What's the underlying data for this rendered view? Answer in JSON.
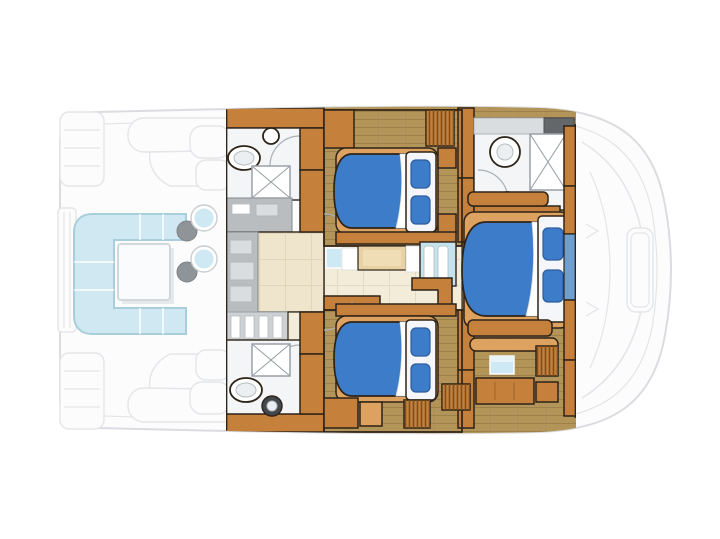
{
  "canvas": {
    "width": 720,
    "height": 539,
    "background": "#ffffff"
  },
  "plan": {
    "type": "floorplan",
    "subject": "catamaran-motor-yacht-lower-deck",
    "view": "overhead",
    "rooms": [
      {
        "id": "stern-platforms",
        "items": [
          "swim-platform-upper",
          "swim-platform-lower",
          "transom-steps"
        ]
      },
      {
        "id": "aft-cockpit",
        "items": [
          "u-shaped-sofa",
          "square-table",
          "bistro-table",
          "bistro-table",
          "chair",
          "chair"
        ]
      },
      {
        "id": "guest-head-forward",
        "items": [
          "toilet",
          "sink",
          "shower"
        ]
      },
      {
        "id": "galley",
        "items": [
          "counter",
          "sink-counter",
          "appliances",
          "steps-down"
        ]
      },
      {
        "id": "guest-head-aft",
        "items": [
          "toilet",
          "sink",
          "shower"
        ]
      },
      {
        "id": "guest-cabin-forward",
        "items": [
          "double-bed",
          "wardrobe",
          "louver-vent"
        ]
      },
      {
        "id": "companionway",
        "items": [
          "bench-seat",
          "cushion",
          "steps",
          "handrail"
        ]
      },
      {
        "id": "guest-cabin-aft",
        "items": [
          "double-bed",
          "wardrobe",
          "louver-vents"
        ]
      },
      {
        "id": "master-head",
        "items": [
          "toilet",
          "sink",
          "shower",
          "vanity-counter"
        ]
      },
      {
        "id": "master-cabin",
        "items": [
          "double-bed",
          "shelf",
          "stool",
          "desk",
          "louver-lockers",
          "chest",
          "hull-window"
        ]
      },
      {
        "id": "foredeck-ghost",
        "items": [
          "bow-hatch",
          "sun-lounge-outline",
          "deck-lines"
        ]
      }
    ],
    "counts": {
      "beds": 3,
      "heads": 3,
      "showers": 3,
      "toilets": 3,
      "sinks": 3
    }
  },
  "colors": {
    "outline": "#2e2317",
    "woodTrim": "#c5803c",
    "woodTrimLight": "#dda25f",
    "woodFloor": "#b3955a",
    "plankLine": "#8a6d39",
    "beigeFloor": "#efe5cd",
    "creamFloor": "#f3ecd9",
    "bathFloor": "#f3f5f7",
    "counterGrey": "#b9bdbf",
    "counterDark": "#63676a",
    "bedBlue": "#3d7cc9",
    "pillowBlue": "#3d7cc9",
    "bedWhite": "#f4f6f9",
    "sofaBlue": "#cfe8f1",
    "sofaLine": "#a9cedb",
    "tableWhite": "#fafbfc",
    "chairGrey": "#8e9497",
    "stepBlue": "#c5e3ee",
    "windowBlue": "#cfe9f4",
    "showerLine": "#9aa0a8",
    "doorArc": "#aab0b5",
    "darkFixture": "#43484c",
    "ghostFill": "#fcfcfd",
    "ghostLine": "#e3e5e8"
  }
}
